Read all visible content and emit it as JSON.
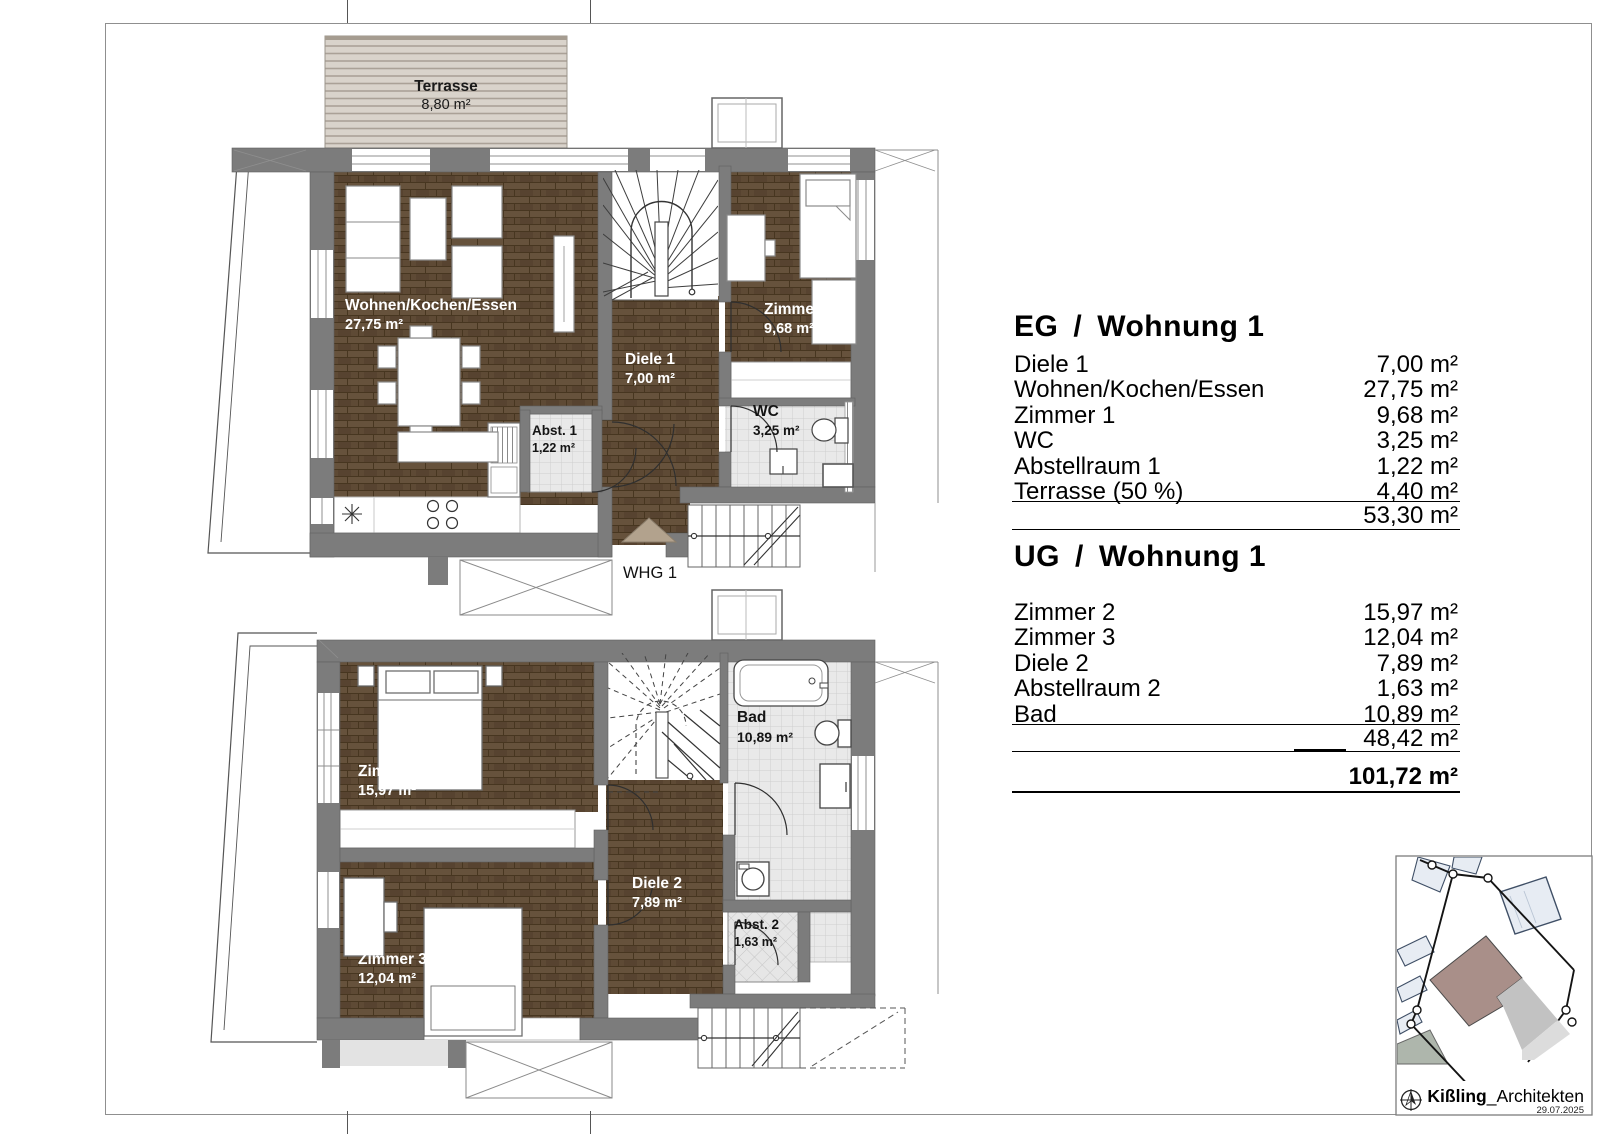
{
  "eg_plan": {
    "terrace": {
      "name": "Terrasse",
      "area": "8,80 m²"
    },
    "rooms": [
      {
        "name": "Wohnen/Kochen/Essen",
        "area": "27,75 m²"
      },
      {
        "name": "Diele 1",
        "area": "7,00 m²"
      },
      {
        "name": "Zimmer 1",
        "area": "9,68 m²"
      },
      {
        "name": "Abst. 1",
        "area": "1,22 m²"
      },
      {
        "name": "WC",
        "area": "3,25 m²"
      }
    ],
    "unit_marker": "WHG 1"
  },
  "ug_plan": {
    "rooms": [
      {
        "name": "Zimmer 2",
        "area": "15,97 m²"
      },
      {
        "name": "Zimmer 3",
        "area": "12,04 m²"
      },
      {
        "name": "Diele 2",
        "area": "7,89 m²"
      },
      {
        "name": "Bad",
        "area": "10,89 m²"
      },
      {
        "name": "Abst. 2",
        "area": "1,63 m²"
      }
    ]
  },
  "eg_table": {
    "floor": "EG",
    "separator": "/",
    "name": "Wohnung 1",
    "rows": [
      {
        "label": "Diele 1",
        "value": "7,00 m²"
      },
      {
        "label": "Wohnen/Kochen/Essen",
        "value": "27,75 m²"
      },
      {
        "label": "Zimmer 1",
        "value": "9,68 m²"
      },
      {
        "label": "WC",
        "value": "3,25 m²"
      },
      {
        "label": "Abstellraum 1",
        "value": "1,22 m²"
      },
      {
        "label": "Terrasse (50 %)",
        "value": "4,40 m²"
      }
    ],
    "total": "53,30 m²"
  },
  "ug_table": {
    "floor": "UG",
    "separator": "/",
    "name": "Wohnung 1",
    "rows": [
      {
        "label": "Zimmer 2",
        "value": "15,97 m²"
      },
      {
        "label": "Zimmer 3",
        "value": "12,04 m²"
      },
      {
        "label": "Diele 2",
        "value": "7,89 m²"
      },
      {
        "label": "Abstellraum 2",
        "value": "1,63 m²"
      },
      {
        "label": "Bad",
        "value": "10,89 m²"
      }
    ],
    "subtotal": "48,42 m²",
    "grand_total": "101,72 m²"
  },
  "titleblock": {
    "firm_bold": "Kißling",
    "firm_rest": "_Architekten",
    "date": "29.07.2025"
  },
  "colors": {
    "wall": "#7c7c7c",
    "wood": "#5e4a35",
    "tile": "#ebebeb",
    "subject_building": "#a98f89"
  }
}
